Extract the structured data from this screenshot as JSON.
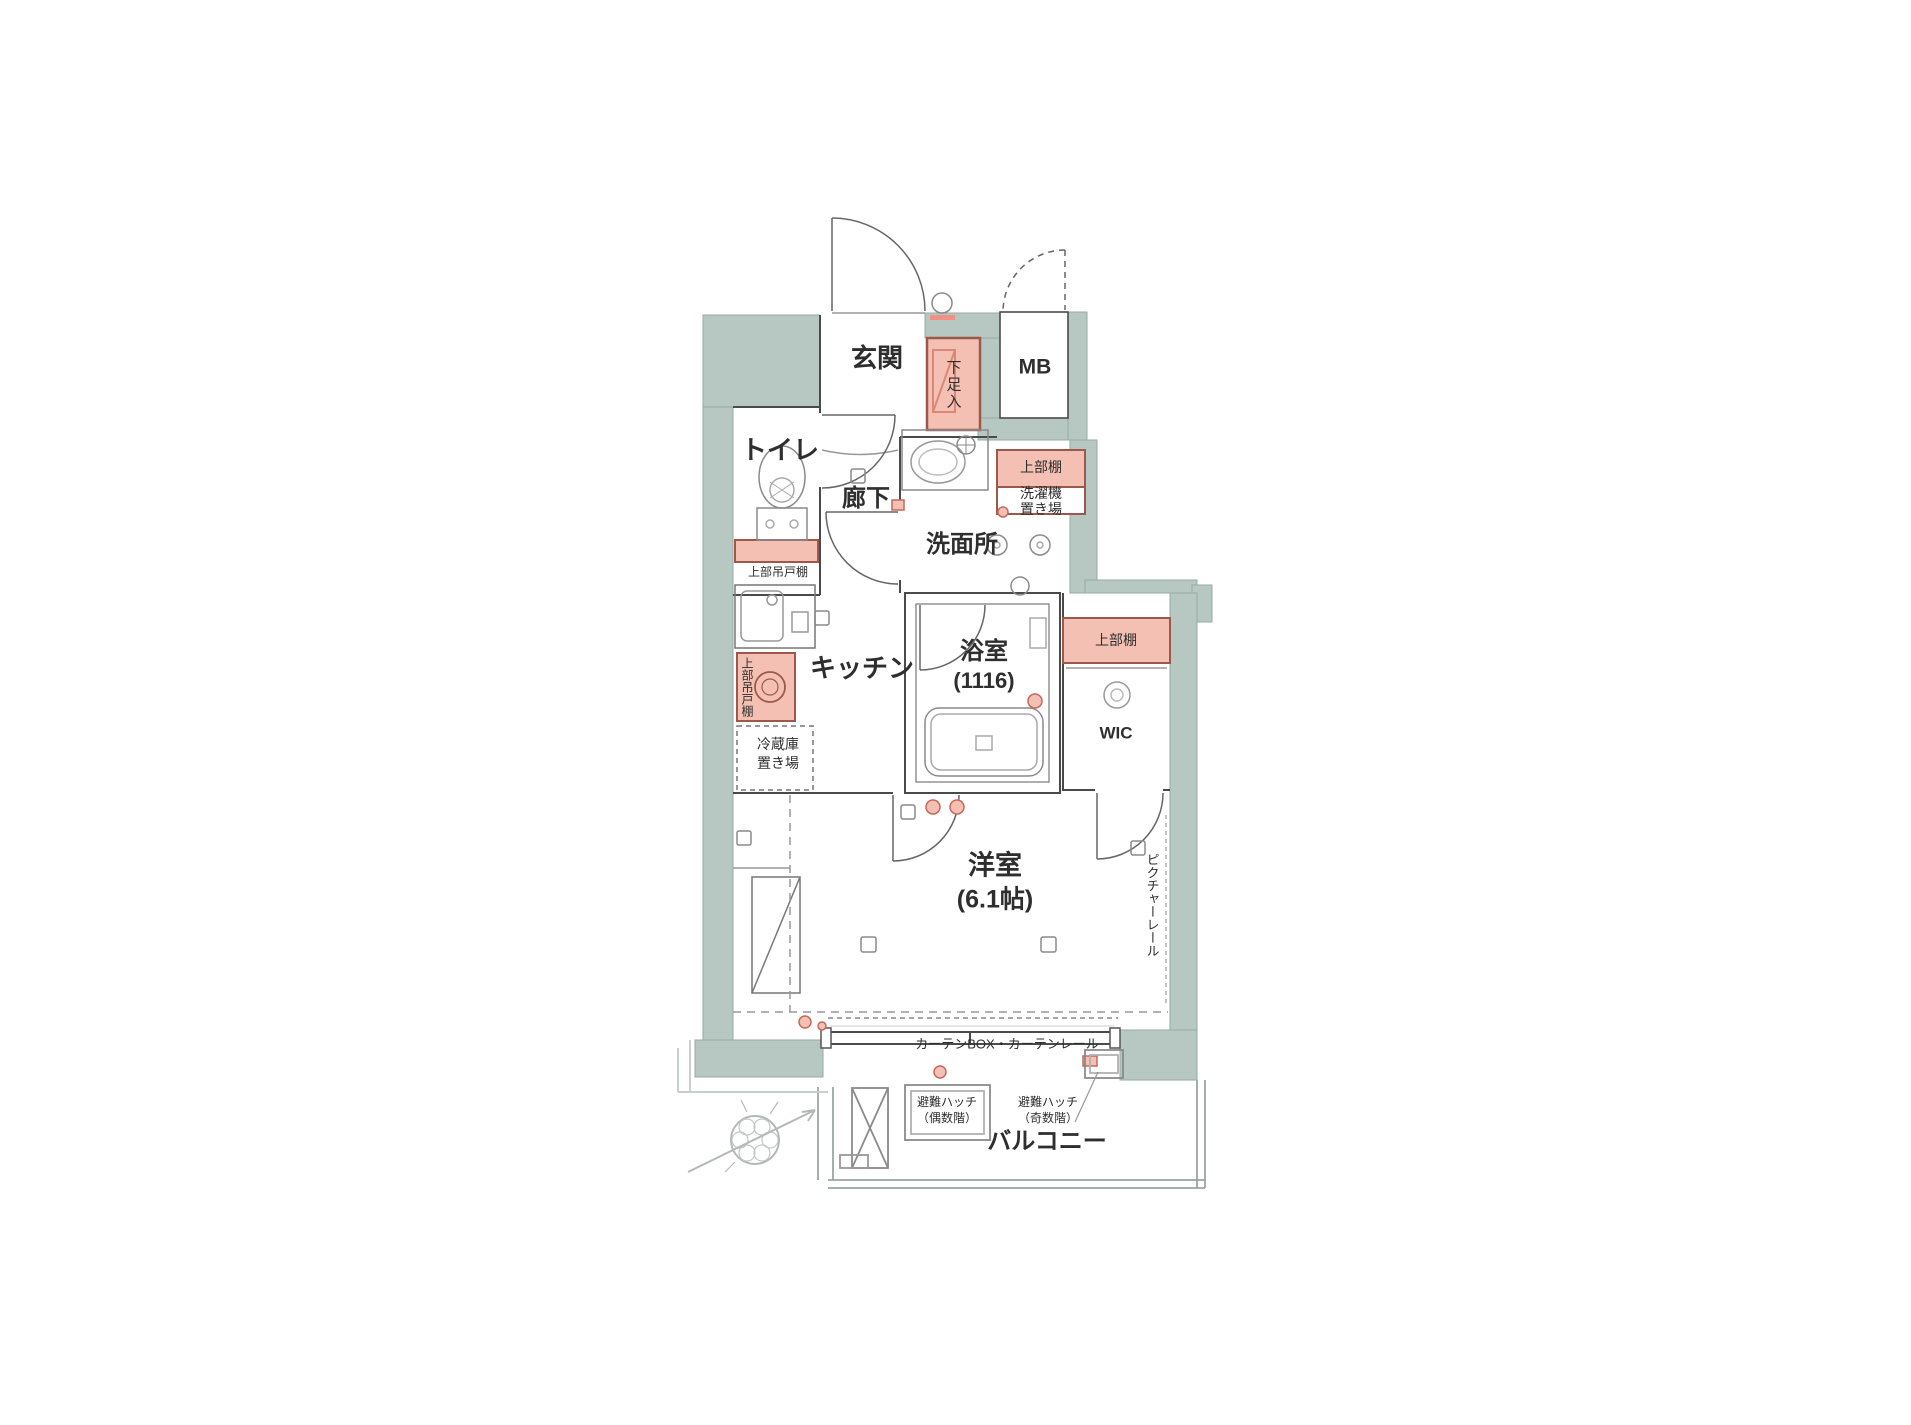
{
  "rooms": {
    "genkan": "玄関",
    "mb": "MB",
    "toilet": "トイレ",
    "hallway": "廊下",
    "washroom": "洗面所",
    "kitchen": "キッチン",
    "bathroom": "浴室",
    "bathroom_size": "(1116)",
    "wic": "WIC",
    "western_room": "洋室",
    "western_room_size": "(6.1帖)",
    "balcony": "バルコニー"
  },
  "labels": {
    "shoe_box": "下足入",
    "toilet_shelf": "上部吊戸棚",
    "washer_shelf": "上部棚",
    "washer_place_1": "洗濯機",
    "washer_place_2": "置き場",
    "kitchen_cabinet": "上部吊戸棚",
    "fridge_1": "冷蔵庫",
    "fridge_2": "置き場",
    "wic_shelf": "上部棚",
    "picture_rail": "ピクチャーレール",
    "curtain_rail": "カーテンBOX・カーテンレール",
    "hatch_even_1": "避難ハッチ",
    "hatch_even_2": "（偶数階）",
    "hatch_odd_1": "避難ハッチ",
    "hatch_odd_2": "（奇数階）"
  },
  "colors": {
    "wall_fill": "#b7c7c1",
    "wall_stroke": "#96aba3",
    "pink_fill": "#f5c0b4",
    "pink_stroke": "#9c584c",
    "line": "#4a4a4a"
  }
}
